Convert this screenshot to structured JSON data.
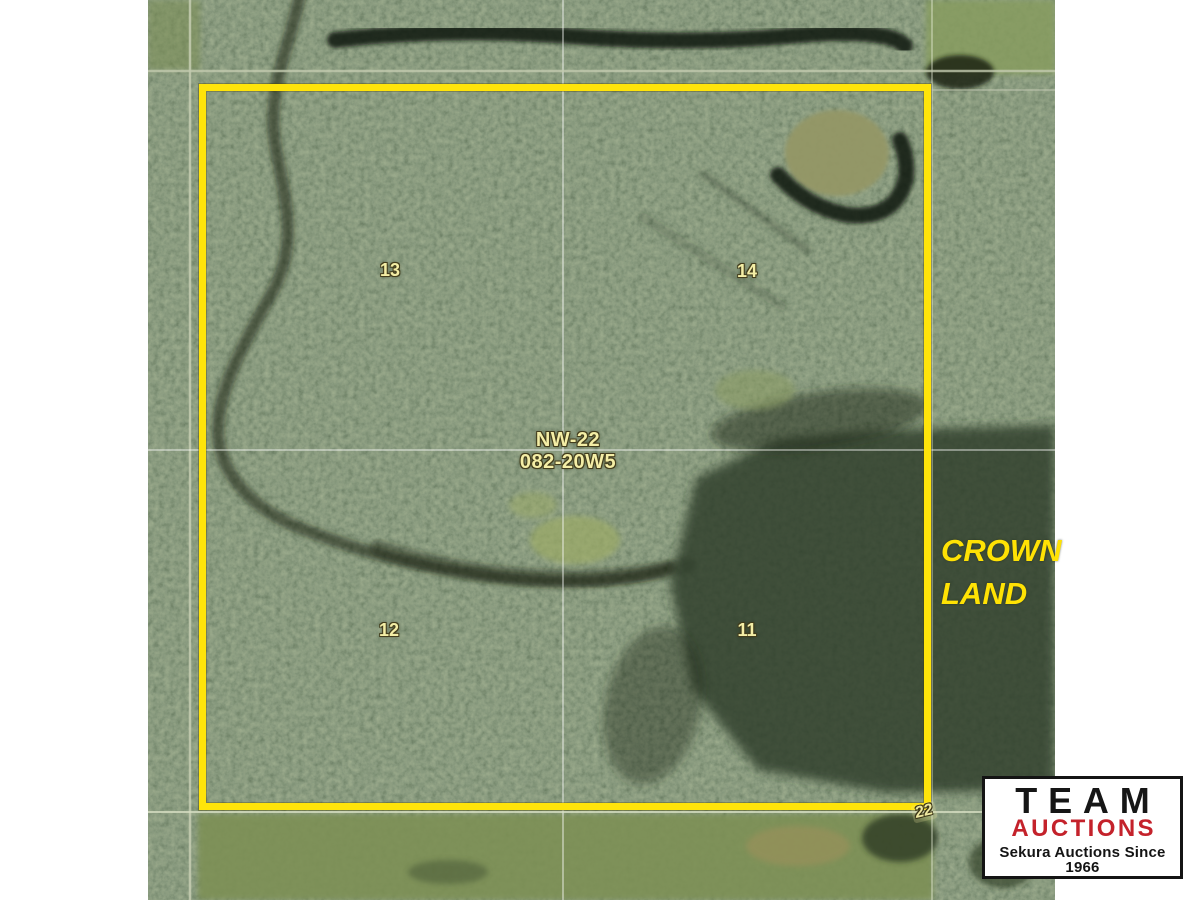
{
  "map": {
    "quarter_labels": [
      {
        "name": "13"
      },
      {
        "name": "14"
      },
      {
        "name": "12"
      },
      {
        "name": "11"
      }
    ],
    "legal_description": {
      "line1": "NW-22",
      "line2": "082-20W5"
    },
    "crown_land": {
      "line1": "CROWN",
      "line2": "LAND"
    },
    "adjacent_section_label": "22",
    "colors": {
      "parcel_boundary": "#ffe40a",
      "parcel_label_text": "#f4eea6",
      "crown_land_text": "#ffe204"
    }
  },
  "logo": {
    "name": "TEAM",
    "word": "AUCTIONS",
    "tagline": "Sekura Auctions Since 1966",
    "accent_color": "#c4222b"
  }
}
